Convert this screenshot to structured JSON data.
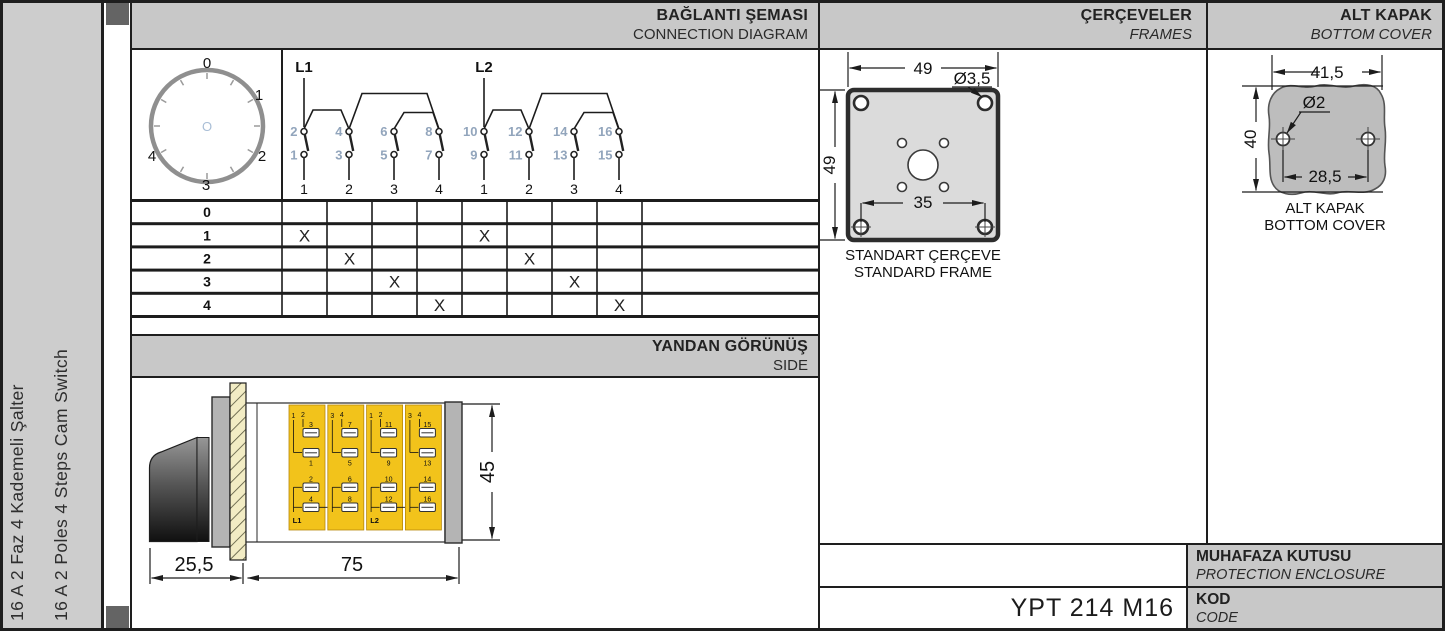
{
  "sidebar": {
    "line1": "16 A 2 Faz 4 Kademeli Şalter",
    "line2": "16 A 2 Poles 4 Steps Cam Switch"
  },
  "headers": {
    "connection": {
      "tr": "BAĞLANTI ŞEMASI",
      "en": "CONNECTION DIAGRAM"
    },
    "frames": {
      "tr": "ÇERÇEVELER",
      "en": "FRAMES"
    },
    "bottom_cover": {
      "tr": "ALT KAPAK",
      "en": "BOTTOM COVER"
    },
    "side": {
      "tr": "YANDAN GÖRÜNÜŞ",
      "en": "SIDE"
    },
    "protection": {
      "tr": "MUHAFAZA KUTUSU",
      "en": "PROTECTION ENCLOSURE"
    },
    "code": {
      "tr": "KOD",
      "en": "CODE"
    }
  },
  "product_code": "YPT 214 M16",
  "dial": {
    "labels": [
      "0",
      "1",
      "2",
      "3",
      "4"
    ],
    "center": "O"
  },
  "connection_diagram": {
    "groups": [
      {
        "label": "L1",
        "terminals": [
          {
            "top": "2",
            "bottom": "1"
          },
          {
            "top": "4",
            "bottom": "3"
          },
          {
            "top": "6",
            "bottom": "5"
          },
          {
            "top": "8",
            "bottom": "7"
          }
        ],
        "outputs": [
          "1",
          "2",
          "3",
          "4"
        ]
      },
      {
        "label": "L2",
        "terminals": [
          {
            "top": "10",
            "bottom": "9"
          },
          {
            "top": "12",
            "bottom": "11"
          },
          {
            "top": "14",
            "bottom": "13"
          },
          {
            "top": "16",
            "bottom": "15"
          }
        ],
        "outputs": [
          "1",
          "2",
          "3",
          "4"
        ]
      }
    ]
  },
  "switch_table": {
    "mark": "X",
    "columns": 8,
    "rows": [
      {
        "label": "0",
        "marks": []
      },
      {
        "label": "1",
        "marks": [
          1,
          5
        ]
      },
      {
        "label": "2",
        "marks": [
          2,
          6
        ]
      },
      {
        "label": "3",
        "marks": [
          3,
          7
        ]
      },
      {
        "label": "4",
        "marks": [
          4,
          8
        ]
      }
    ]
  },
  "side_view": {
    "dims": {
      "depth": "25,5",
      "length": "75",
      "height": "45"
    },
    "modules": [
      {
        "pair": [
          "1",
          "2"
        ],
        "nums": [
          "3",
          "1",
          "2",
          "4"
        ],
        "line_label": "L1"
      },
      {
        "pair": [
          "3",
          "4"
        ],
        "nums": [
          "7",
          "5",
          "6",
          "8"
        ],
        "line_label": ""
      },
      {
        "pair": [
          "1",
          "2"
        ],
        "nums": [
          "11",
          "9",
          "10",
          "12"
        ],
        "line_label": "L2"
      },
      {
        "pair": [
          "3",
          "4"
        ],
        "nums": [
          "15",
          "13",
          "14",
          "16"
        ],
        "line_label": ""
      }
    ]
  },
  "frame": {
    "dims": {
      "width": "49",
      "height": "49",
      "inner": "35",
      "hole": "Ø3,5"
    },
    "caption_tr": "STANDART ÇERÇEVE",
    "caption_en": "STANDARD FRAME"
  },
  "cover": {
    "dims": {
      "width": "41,5",
      "height": "40",
      "holes": "28,5",
      "hole_d": "Ø2"
    },
    "caption_tr": "ALT KAPAK",
    "caption_en": "BOTTOM COVER"
  },
  "colors": {
    "header_gray": "#c8c8c8",
    "module_yellow": "#f2c31b",
    "terminal_blue": "#92a5bc",
    "frame_fill": "#dbdbdb",
    "cover_fill": "#bdbdbd"
  }
}
